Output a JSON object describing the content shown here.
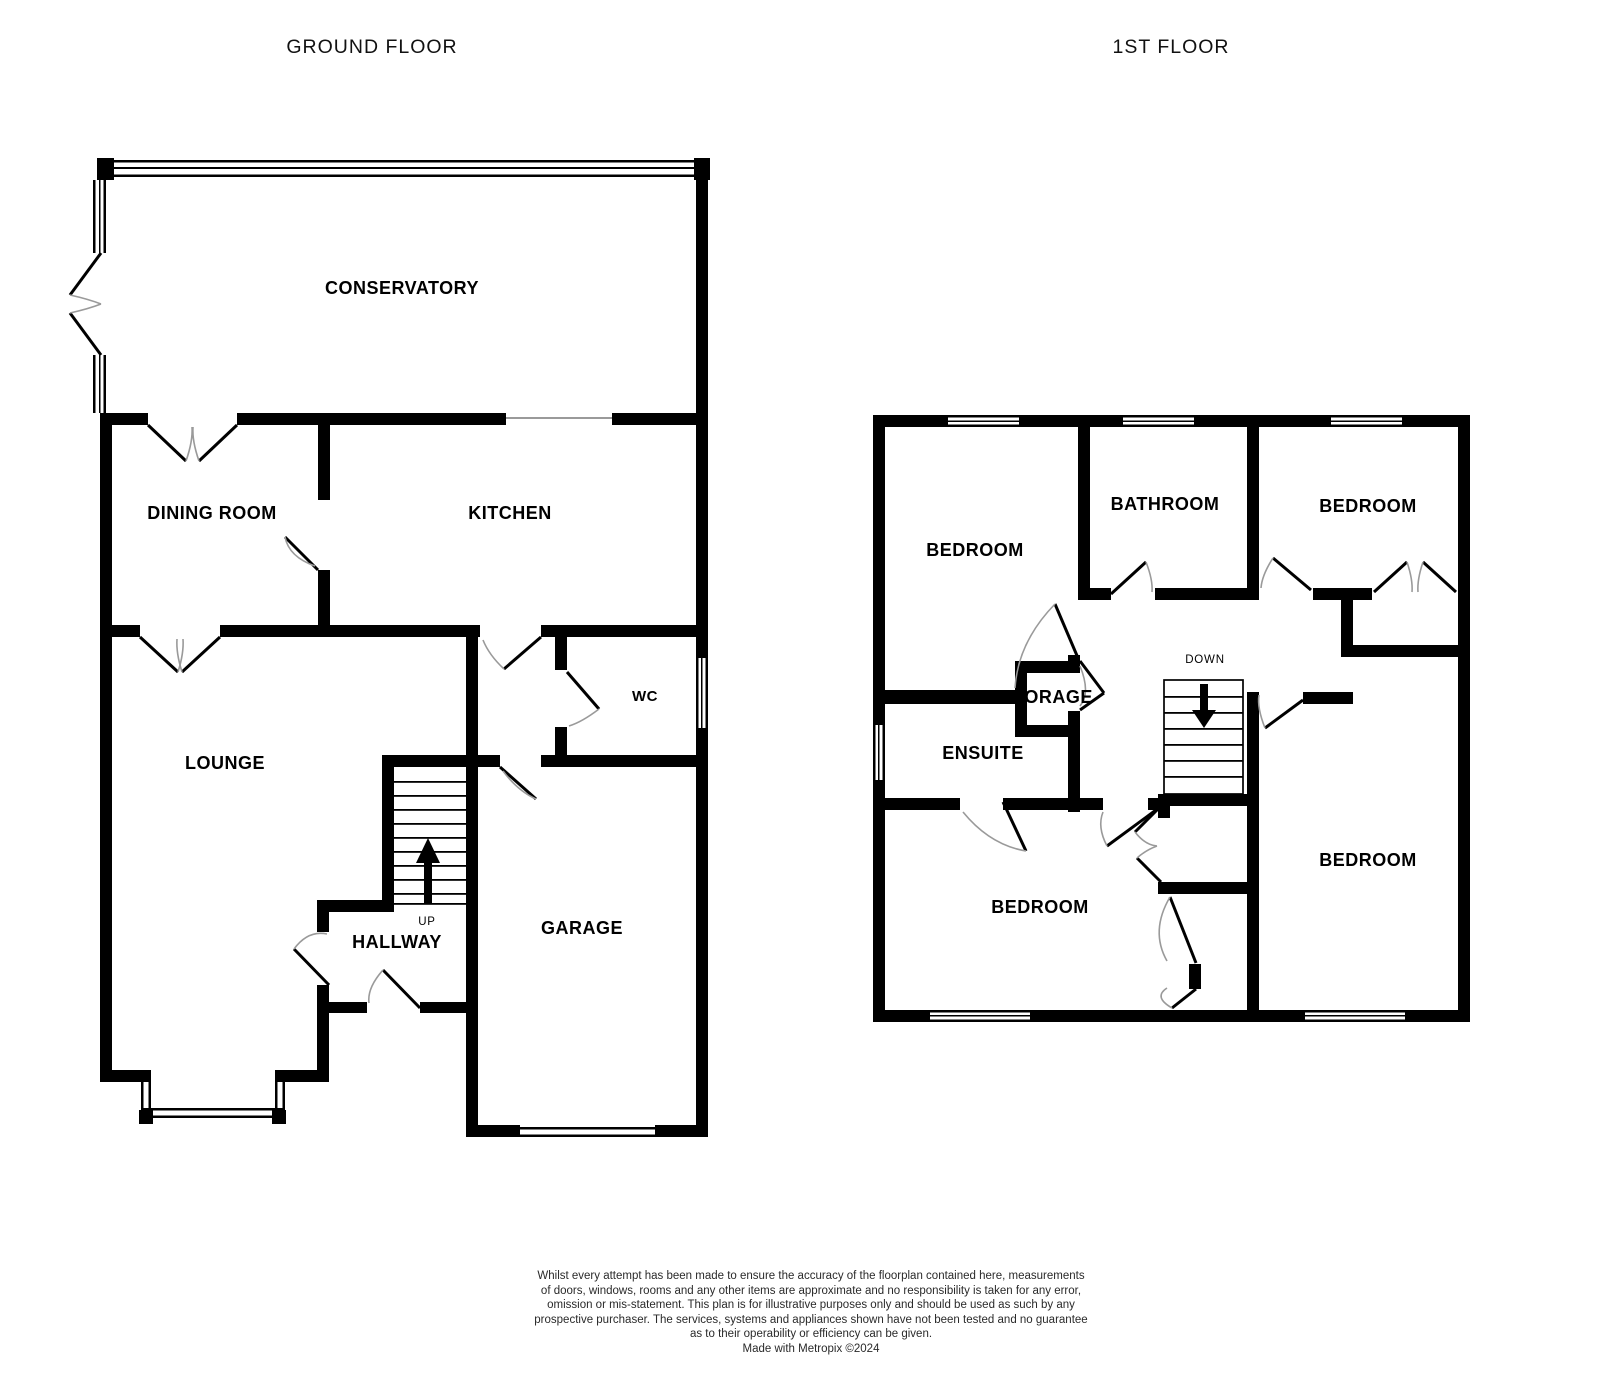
{
  "page": {
    "background": "#ffffff"
  },
  "colors": {
    "wall": "#000000",
    "door_arc": "#9a9a9a",
    "text": "#000000"
  },
  "ground_floor": {
    "title": "GROUND FLOOR",
    "rooms": {
      "conservatory": "CONSERVATORY",
      "dining_room": "DINING ROOM",
      "kitchen": "KITCHEN",
      "wc": "WC",
      "lounge": "LOUNGE",
      "hallway": "HALLWAY",
      "garage": "GARAGE"
    },
    "stair_label": "UP"
  },
  "first_floor": {
    "title": "1ST FLOOR",
    "rooms": {
      "bedroom_top_left": "BEDROOM",
      "bathroom": "BATHROOM",
      "bedroom_top_right": "BEDROOM",
      "storage": "TORAGE",
      "ensuite": "ENSUITE",
      "bedroom_bottom_left": "BEDROOM",
      "bedroom_bottom_right": "BEDROOM"
    },
    "stair_label": "DOWN"
  },
  "disclaimer": {
    "lines": [
      "Whilst every attempt has been made to ensure the accuracy of the floorplan contained here, measurements",
      "of doors, windows, rooms and any other items are approximate and no responsibility is taken for any error,",
      "omission or mis-statement. This plan is for illustrative purposes only and should be used as such by any",
      "prospective purchaser. The services, systems and appliances shown have not been tested and no guarantee",
      "as to their operability or efficiency can be given."
    ],
    "credit": "Made with Metropix ©2024"
  }
}
